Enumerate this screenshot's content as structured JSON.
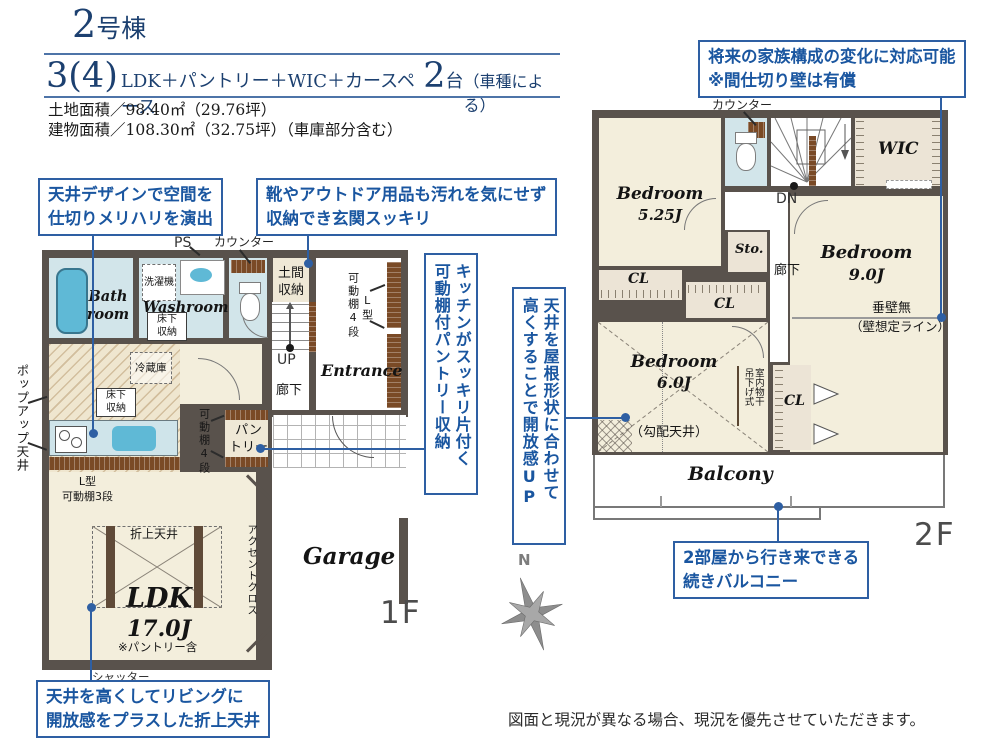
{
  "colors": {
    "accent_blue": "#2e5fa3",
    "navy": "#1c4070",
    "wall": "#59524c",
    "cream": "#f3eedc",
    "wet_blue": "#d2e5ea",
    "fixture_blue": "#5fb9d6",
    "beige": "#ece5d6",
    "shelf_brown": "#7a4a26"
  },
  "header": {
    "bldg_num": "2",
    "bldg_suffix": "号棟",
    "plan_num": "3(4)",
    "plan_text": "LDK＋パントリー＋WIC＋カースペース",
    "car_num": "2",
    "car_unit": "台",
    "car_note": "（車種による）",
    "land": "土地面積／98.40㎡（29.76坪）",
    "building": "建物面積／108.30㎡（32.75坪）（車庫部分含む）"
  },
  "callouts": {
    "ceiling_design": {
      "l1": "天井デザインで空間を",
      "l2": "仕切りメリハリを演出"
    },
    "genkan": {
      "l1": "靴やアウトドア用品も汚れを気にせず",
      "l2": "収納でき玄関スッキリ"
    },
    "pantry": {
      "l1": "キッチンがスッキリ片付く",
      "l2": "可動棚付パントリー収納"
    },
    "slope": {
      "l1": "天井を屋根形状に合わせて",
      "l2": "高くすることで開放感UP"
    },
    "future": {
      "l1": "将来の家族構成の変化に対応可能",
      "l2": "※間仕切り壁は有償"
    },
    "balcony": {
      "l1": "2部屋から行き来できる",
      "l2": "続きバルコニー"
    },
    "oriage": {
      "l1": "天井を高くしてリビングに",
      "l2": "開放感をプラスした折上天井"
    }
  },
  "f1": {
    "floor": "1F",
    "ps": "PS",
    "counter": "カウンター",
    "washer": "洗濯機",
    "bath1": "Bath",
    "bath2": "room",
    "washroom": "Washroom",
    "yukashita1": "床下",
    "yukashita2": "収納",
    "doma1": "土間",
    "doma2": "収納",
    "shelf4": "可動棚4段",
    "ltype": "L型",
    "up": "UP",
    "entrance": "Entrance",
    "hall": "廊下",
    "fridge": "冷蔵庫",
    "pantry1": "パン",
    "pantry2": "トリー",
    "lshelf1": "L型",
    "lshelf2": "可動棚3段",
    "oriage": "折上天井",
    "ldk": "LDK",
    "ldk_size": "17.0J",
    "ldk_note": "※パントリー含",
    "accent": "アクセントクロス",
    "shutter": "シャッター",
    "popup": "ポップアップ天井",
    "garage": "Garage"
  },
  "f2": {
    "floor": "2F",
    "counter": "カウンター",
    "dn": "DN",
    "wic": "WIC",
    "bed1": "Bedroom",
    "bed1_size": "5.25J",
    "sto": "Sto.",
    "hall": "廊下",
    "bed2": "Bedroom",
    "bed2_size": "9.0J",
    "tarekabe1": "垂壁無",
    "tarekabe2": "（壁想定ライン）",
    "cl": "CL",
    "bed3": "Bedroom",
    "bed3_size": "6.0J",
    "slope_note": "（勾配天井）",
    "monohoshi1": "室内物干",
    "monohoshi2": "吊下げ式",
    "balcony": "Balcony"
  },
  "compass": {
    "n": "N"
  },
  "footer": {
    "note": "図面と現況が異なる場合、現況を優先させていただきます。"
  }
}
